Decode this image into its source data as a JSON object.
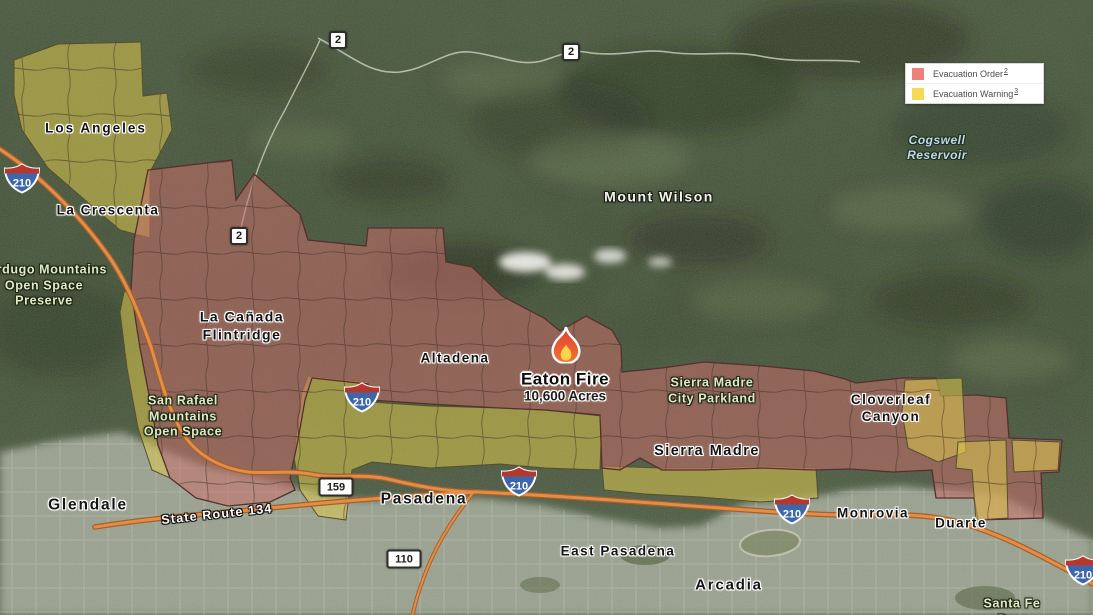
{
  "legend": {
    "items": [
      {
        "label": "Evacuation Order",
        "footnote": "2",
        "color": "#ee7f7d"
      },
      {
        "label": "Evacuation Warning",
        "footnote": "3",
        "color": "#f6da57"
      }
    ]
  },
  "fire": {
    "name": "Eaton Fire",
    "size": "10,600 Acres"
  },
  "labels": {
    "los_angeles": "Los Angeles",
    "la_crescenta": "La Crescenta",
    "verdugo": "Verdugo Mountains\nOpen Space\nPreserve",
    "la_canada": "La Cañada\nFlintridge",
    "altadena": "Altadena",
    "mount_wilson": "Mount Wilson",
    "cogswell": "Cogswell\nReservoir",
    "sierra_madre_parkland": "Sierra Madre\nCity Parkland",
    "cloverleaf": "Cloverleaf\nCanyon",
    "san_rafael": "San Rafael\nMountains\nOpen Space",
    "sierra_madre": "Sierra Madre",
    "glendale": "Glendale",
    "state_route_134": "State Route 134",
    "pasadena": "Pasadena",
    "east_pasadena": "East Pasadena",
    "arcadia": "Arcadia",
    "monrovia": "Monrovia",
    "duarte": "Duarte",
    "santa_fe_dam": "Santa Fe Dam"
  },
  "shields": {
    "interstate_210": "210",
    "route_2": "2",
    "route_159": "159",
    "route_110": "110"
  },
  "colors": {
    "evacuation_order_fill": "#c8706c",
    "evacuation_warning_fill": "#ddc84e"
  }
}
